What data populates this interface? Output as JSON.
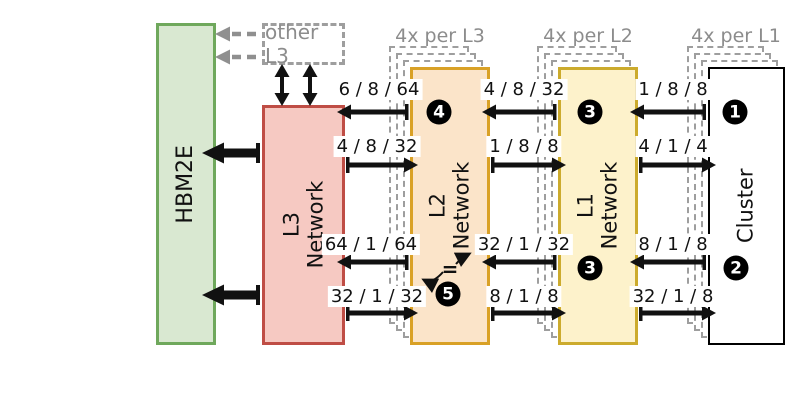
{
  "figure": {
    "blocks": {
      "hbm2e": {
        "label": "HBM2E"
      },
      "l3": {
        "line1": "L3",
        "line2": "Network"
      },
      "l2": {
        "line1": "L2",
        "line2": "Network",
        "multiplicity": "4x per L3"
      },
      "l1": {
        "line1": "L1",
        "line2": "Network",
        "multiplicity": "4x per L2"
      },
      "cluster": {
        "label": "Cluster",
        "multiplicity": "4x per L1"
      }
    },
    "other_l3": {
      "label": "other L3"
    },
    "bandwidths": {
      "row1": [
        "6 / 8 / 64",
        "4 / 8 / 32",
        "1 / 8 / 8"
      ],
      "row2": [
        "4 / 8 / 32",
        "1 / 8 / 8",
        "4 / 1 / 4"
      ],
      "row3": [
        "64 / 1 / 64",
        "32 / 1 / 32",
        "8 / 1 / 8"
      ],
      "row4": [
        "32 / 1 / 32",
        "8 / 1 / 8",
        "32 / 1 / 8"
      ]
    },
    "callouts": {
      "c1": "1",
      "c2": "2",
      "c3_top": "3",
      "c3_bottom": "3",
      "c4": "4",
      "c5": "5"
    },
    "equals_annotation": "="
  },
  "colors": {
    "green-fill": "#d9e8d1",
    "green-border": "#6fa85c",
    "red-fill": "#f6c9c2",
    "red-border": "#bf4d45",
    "orange-fill": "#fbe4c9",
    "orange-border": "#d9a126",
    "yellow-fill": "#fdf2cb",
    "yellow-border": "#ccab2d",
    "gray-text": "#8c8c8c",
    "gray-line": "#8f8f8f",
    "ghost": "#9e9e9e",
    "ink": "#111111"
  }
}
